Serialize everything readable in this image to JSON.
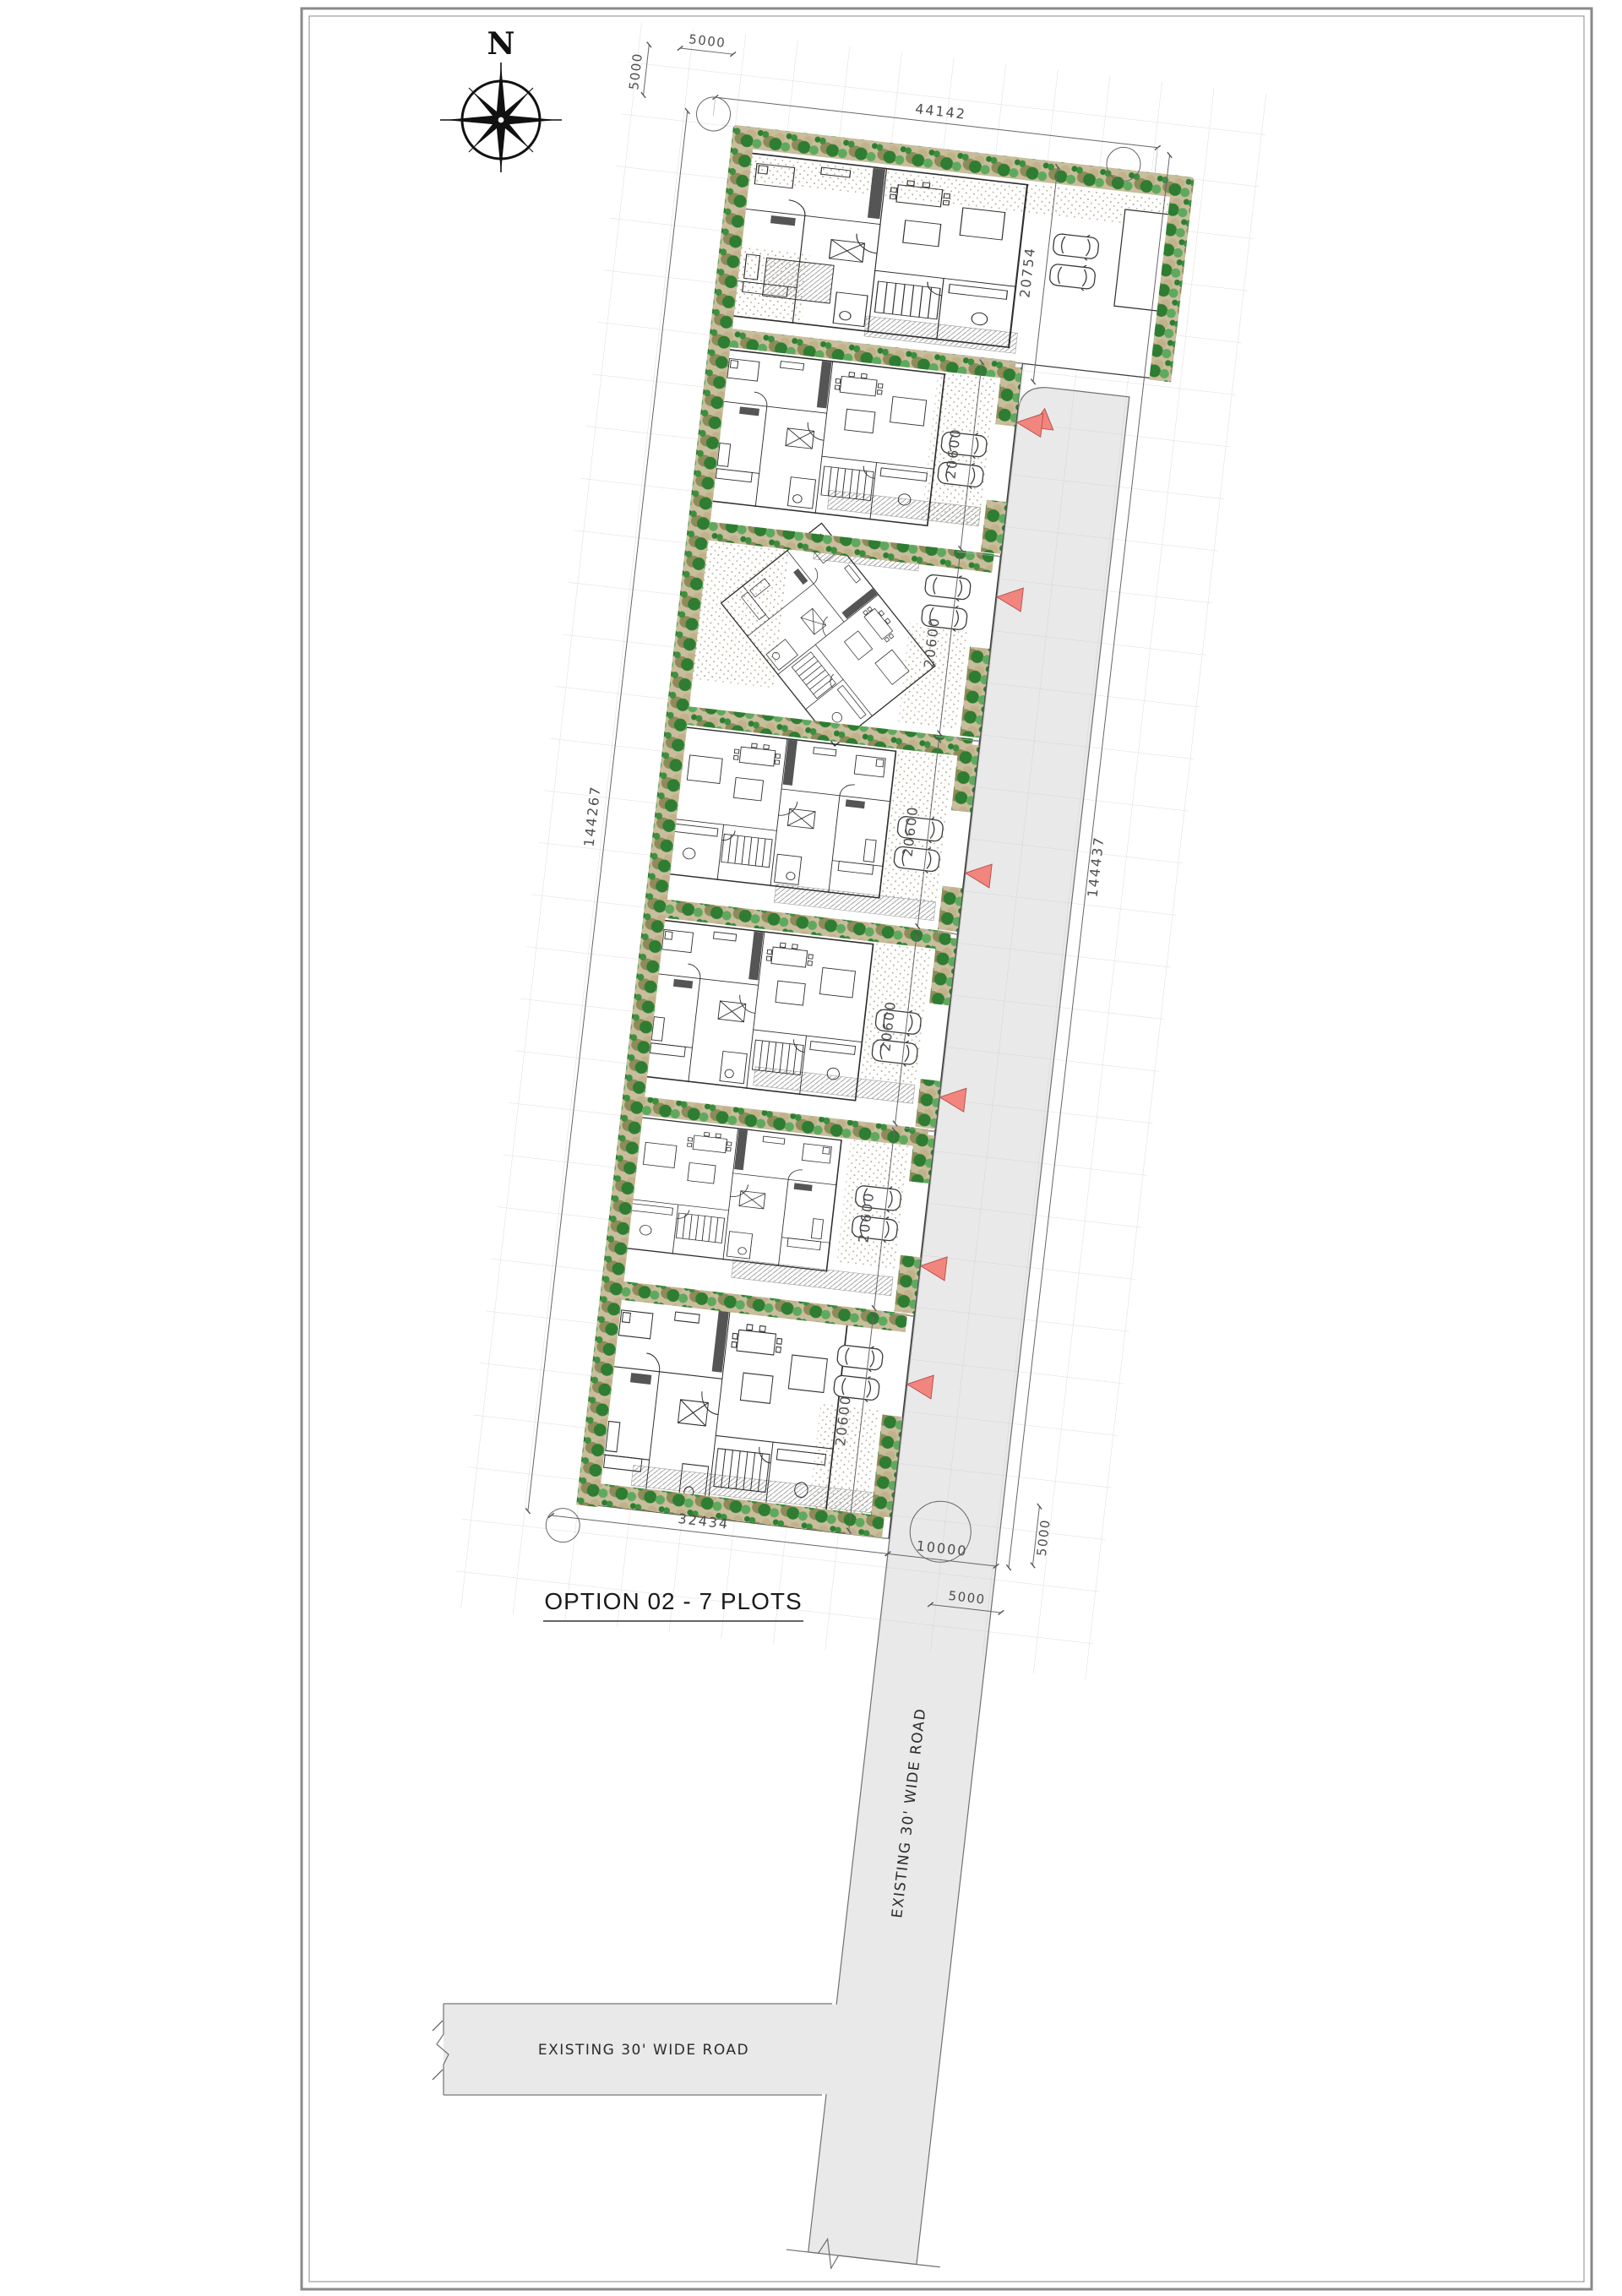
{
  "sheet": {
    "title": "OPTION 02 - 7 PLOTS",
    "type_note": "architectural site plan, 7 residential plots along a road"
  },
  "compass": {
    "label": "N"
  },
  "dimensions": {
    "top_width": "44142",
    "top_offset_horizontal": "5000",
    "top_offset_vertical": "5000",
    "left_total_length": "144267",
    "right_total_length": "144437",
    "bottom_width": "32434",
    "road_width": "10000",
    "bottom_offset_vertical": "5000",
    "bottom_offset_diagonal": "5000"
  },
  "plots": [
    {
      "name": "Plot 1",
      "depth": "20754"
    },
    {
      "name": "Plot 2",
      "depth": "20600"
    },
    {
      "name": "Plot 3",
      "depth": "20600"
    },
    {
      "name": "Plot 4",
      "depth": "20600"
    },
    {
      "name": "Plot 5",
      "depth": "20600"
    },
    {
      "name": "Plot 6",
      "depth": "20600"
    },
    {
      "name": "Plot 7",
      "depth": "20600"
    }
  ],
  "roads": {
    "vertical_label": "EXISTING 30' WIDE ROAD",
    "horizontal_label": "EXISTING 30' WIDE ROAD"
  },
  "colors": {
    "road_fill": "#e9e9e9",
    "entry_triangle": "#f2867e",
    "tree_dark_green": "#2e7d32",
    "tree_light_green": "#5fa95f",
    "planting_band": "#c8bd9c",
    "grid_line": "#dcdcdc",
    "drawing_line": "#2e2e2e"
  }
}
